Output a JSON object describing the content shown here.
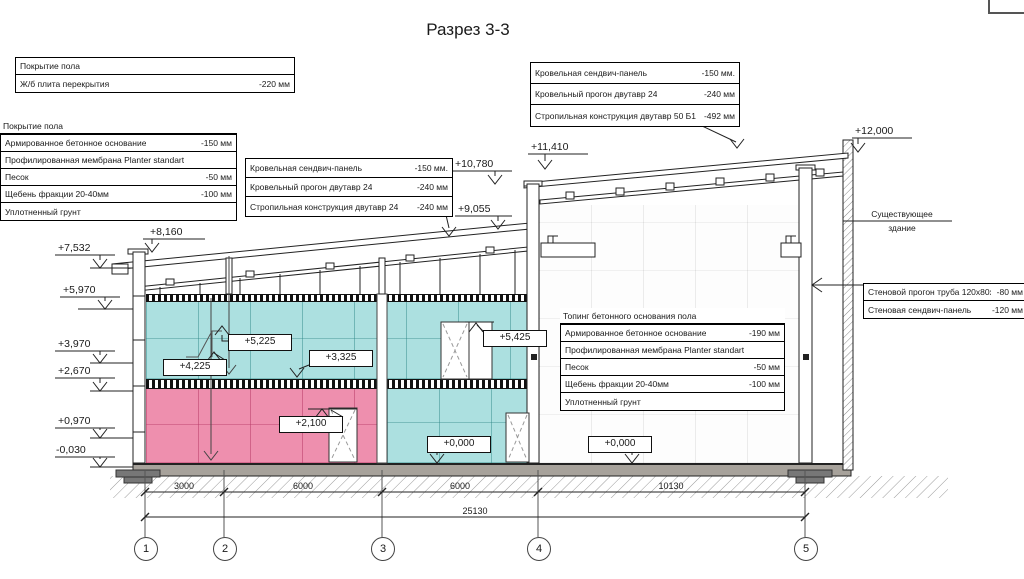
{
  "title": "Разрез 3-3",
  "callouts": {
    "floor_slab": {
      "rows": [
        {
          "name": "Покрытие пола",
          "value": ""
        },
        {
          "name": "Ж/б плита перекрытия",
          "value": "-220 мм"
        }
      ]
    },
    "ground_floor_left": {
      "header": "Покрытие пола",
      "rows": [
        {
          "name": "Армированное бетонное основание",
          "value": "-150 мм"
        },
        {
          "name": "Профилированная мембрана Planter standart",
          "value": ""
        },
        {
          "name": "Песок",
          "value": "-50 мм"
        },
        {
          "name": "Щебень фракции 20-40мм",
          "value": "-100 мм"
        },
        {
          "name": "Уплотненный грунт",
          "value": ""
        }
      ]
    },
    "roof_left": {
      "rows": [
        {
          "name": "Кровельная сендвич-панель",
          "value": "-150 мм."
        },
        {
          "name": "Кровельный прогон двутавр 24",
          "value": "-240 мм"
        },
        {
          "name": "Стропильная конструкция двутавр 24",
          "value": "-240 мм"
        }
      ]
    },
    "roof_right": {
      "rows": [
        {
          "name": "Кровельная сендвич-панель",
          "value": "-150 мм."
        },
        {
          "name": "Кровельный прогон двутавр 24",
          "value": "-240 мм"
        },
        {
          "name": "Стропильная конструкция двутавр 50 Б1",
          "value": "-492 мм"
        }
      ]
    },
    "ground_floor_right": {
      "header": "Топинг бетонного основания пола",
      "rows": [
        {
          "name": "Армированное бетонное основание",
          "value": "-190 мм"
        },
        {
          "name": "Профилированная мембрана Planter standart",
          "value": ""
        },
        {
          "name": "Песок",
          "value": "-50 мм"
        },
        {
          "name": "Щебень фракции 20-40мм",
          "value": "-100 мм"
        },
        {
          "name": "Уплотненный грунт",
          "value": ""
        }
      ]
    },
    "wall_right": {
      "rows": [
        {
          "name": "Стеновой прогон труба 120х80х3",
          "value": "-80 мм"
        },
        {
          "name": "Стеновая сендвич-панель",
          "value": "-120 мм"
        }
      ]
    }
  },
  "labels": {
    "existing_building_line1": "Существующее",
    "existing_building_line2": "здание"
  },
  "elevations": {
    "e8160": "+8,160",
    "e7532": "+7,532",
    "e5970": "+5,970",
    "e3970": "+3,970",
    "e2670": "+2,670",
    "e0970": "+0,970",
    "em0030": "-0,030",
    "e10780": "+10,780",
    "e9055": "+9,055",
    "e11410": "+11,410",
    "e12000": "+12,000",
    "i5225": "+5,225",
    "i4225": "+4,225",
    "i3325": "+3,325",
    "i2100": "+2,100",
    "i0000_left": "+0,000",
    "i5425": "+5,425",
    "i0000_right": "+0,000"
  },
  "dimensions": {
    "d12": "3000",
    "d23": "6000",
    "d34": "6000",
    "d45": "10130",
    "total": "25130"
  },
  "axes": {
    "a1": "1",
    "a2": "2",
    "a3": "3",
    "a4": "4",
    "a5": "5"
  },
  "colors": {
    "zone_cyan": "#ace0e0",
    "zone_pink": "#ee8fae",
    "line": "#222222",
    "slab_gray": "#a7a29b"
  }
}
